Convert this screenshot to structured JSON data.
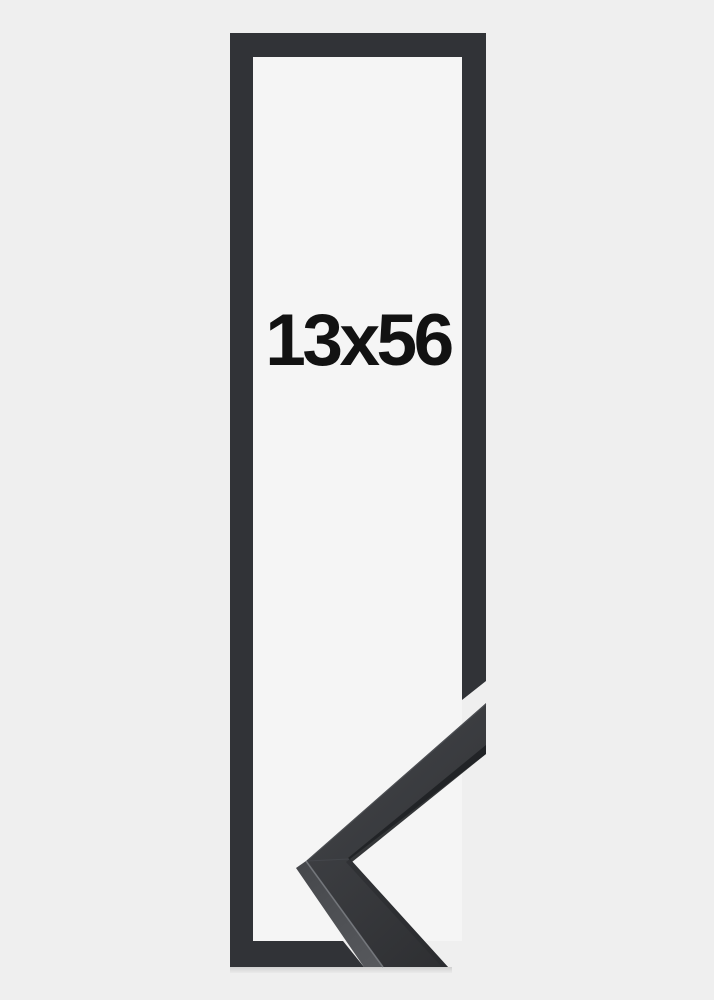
{
  "product": {
    "size_label": "13x56"
  },
  "colors": {
    "background": "#efefef",
    "interior": "#f5f5f5",
    "frame": "#313337",
    "moulding_face_light": "#404246",
    "moulding_face_dark": "#2d2e31",
    "moulding_side_light": "#56585c",
    "moulding_side_dark": "#46484c",
    "edge_strip": "#1f2124",
    "inner_edge_shadow": "#2a2b2e",
    "arris_highlight": "#7a7d82",
    "outer_edge_highlight": "#5e6166",
    "miter_seam": "#50535a",
    "label_text": "#121212"
  }
}
